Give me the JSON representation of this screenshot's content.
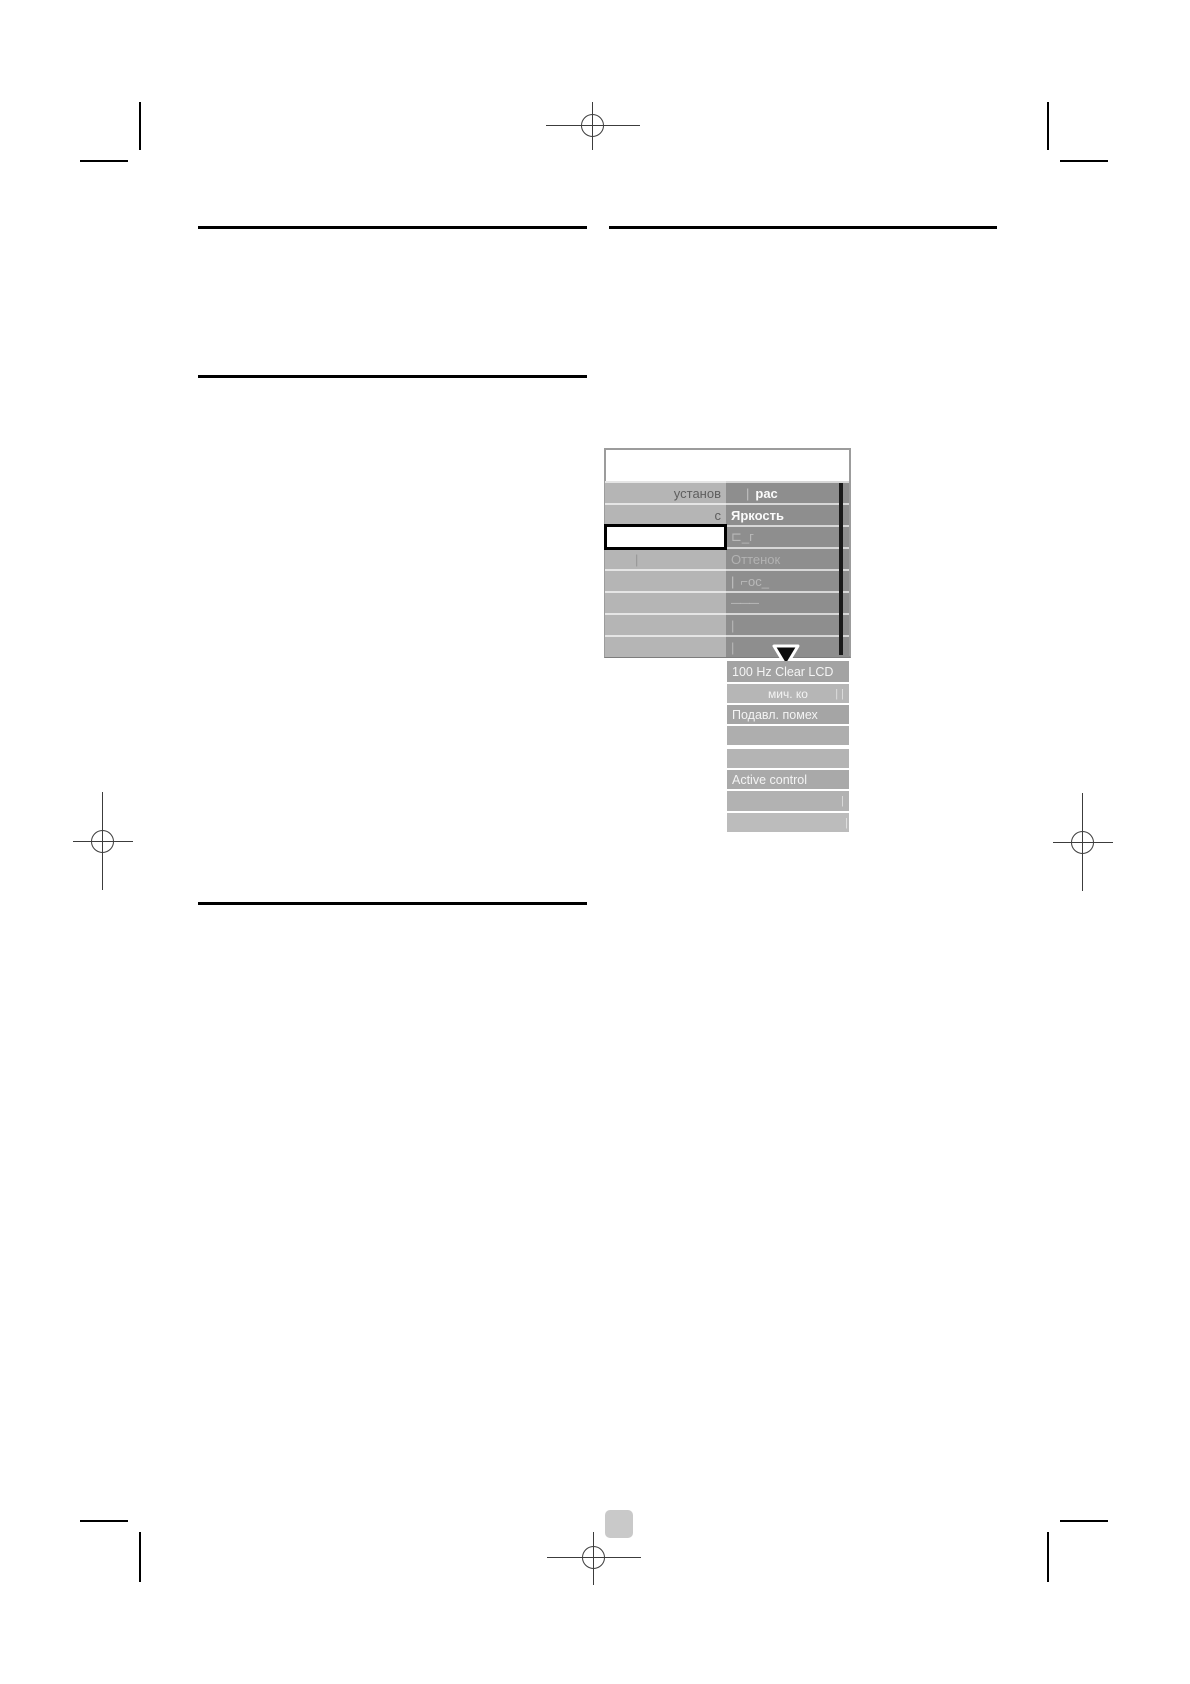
{
  "menu": {
    "header_text": "",
    "left_rows": [
      {
        "text": "установ"
      },
      {
        "text": "с"
      },
      {
        "text": ""
      },
      {
        "text": "|"
      },
      {
        "text": ""
      },
      {
        "text": ""
      },
      {
        "text": ""
      },
      {
        "text": ""
      }
    ],
    "right_rows": [
      {
        "prefix": "|",
        "text": "рас"
      },
      {
        "prefix": "",
        "text": "Яркость"
      },
      {
        "prefix": "",
        "text": "⊏_г"
      },
      {
        "prefix": "",
        "text": "Оттенок"
      },
      {
        "prefix": "|",
        "text": "⌐ос_"
      },
      {
        "prefix": "",
        "text": "———"
      },
      {
        "prefix": "",
        "text": "|"
      },
      {
        "prefix": "",
        "text": "|"
      }
    ],
    "lower_rows": [
      {
        "text": "100 Hz Clear LCD",
        "right_tick": ""
      },
      {
        "text": "мич. ко",
        "right_tick": "| |"
      },
      {
        "text": "Подавл. помех",
        "right_tick": ""
      },
      {
        "text": "",
        "right_tick": ""
      },
      {
        "text": "",
        "right_tick": ""
      },
      {
        "text": "Active control",
        "right_tick": ""
      },
      {
        "text": "",
        "right_tick": "|"
      },
      {
        "text": "",
        "right_tick": "|"
      }
    ],
    "colors": {
      "left_column_bg": "#b5b5b5",
      "right_column_bg": "#8e8e8e",
      "lower_row_bg": "#a9a9a9",
      "selected_row_bg": "#ffffff",
      "selected_row_border": "#000000",
      "scrollbar": "#1a1a1a",
      "menu_text_bright": "#f7f7f7",
      "menu_text_dim": "#5e5e5e"
    }
  },
  "page_marks": {
    "page_number_box_color": "#c9c9c9",
    "rule_color": "#000000",
    "registration_mark_color": "#3c3c3c"
  }
}
